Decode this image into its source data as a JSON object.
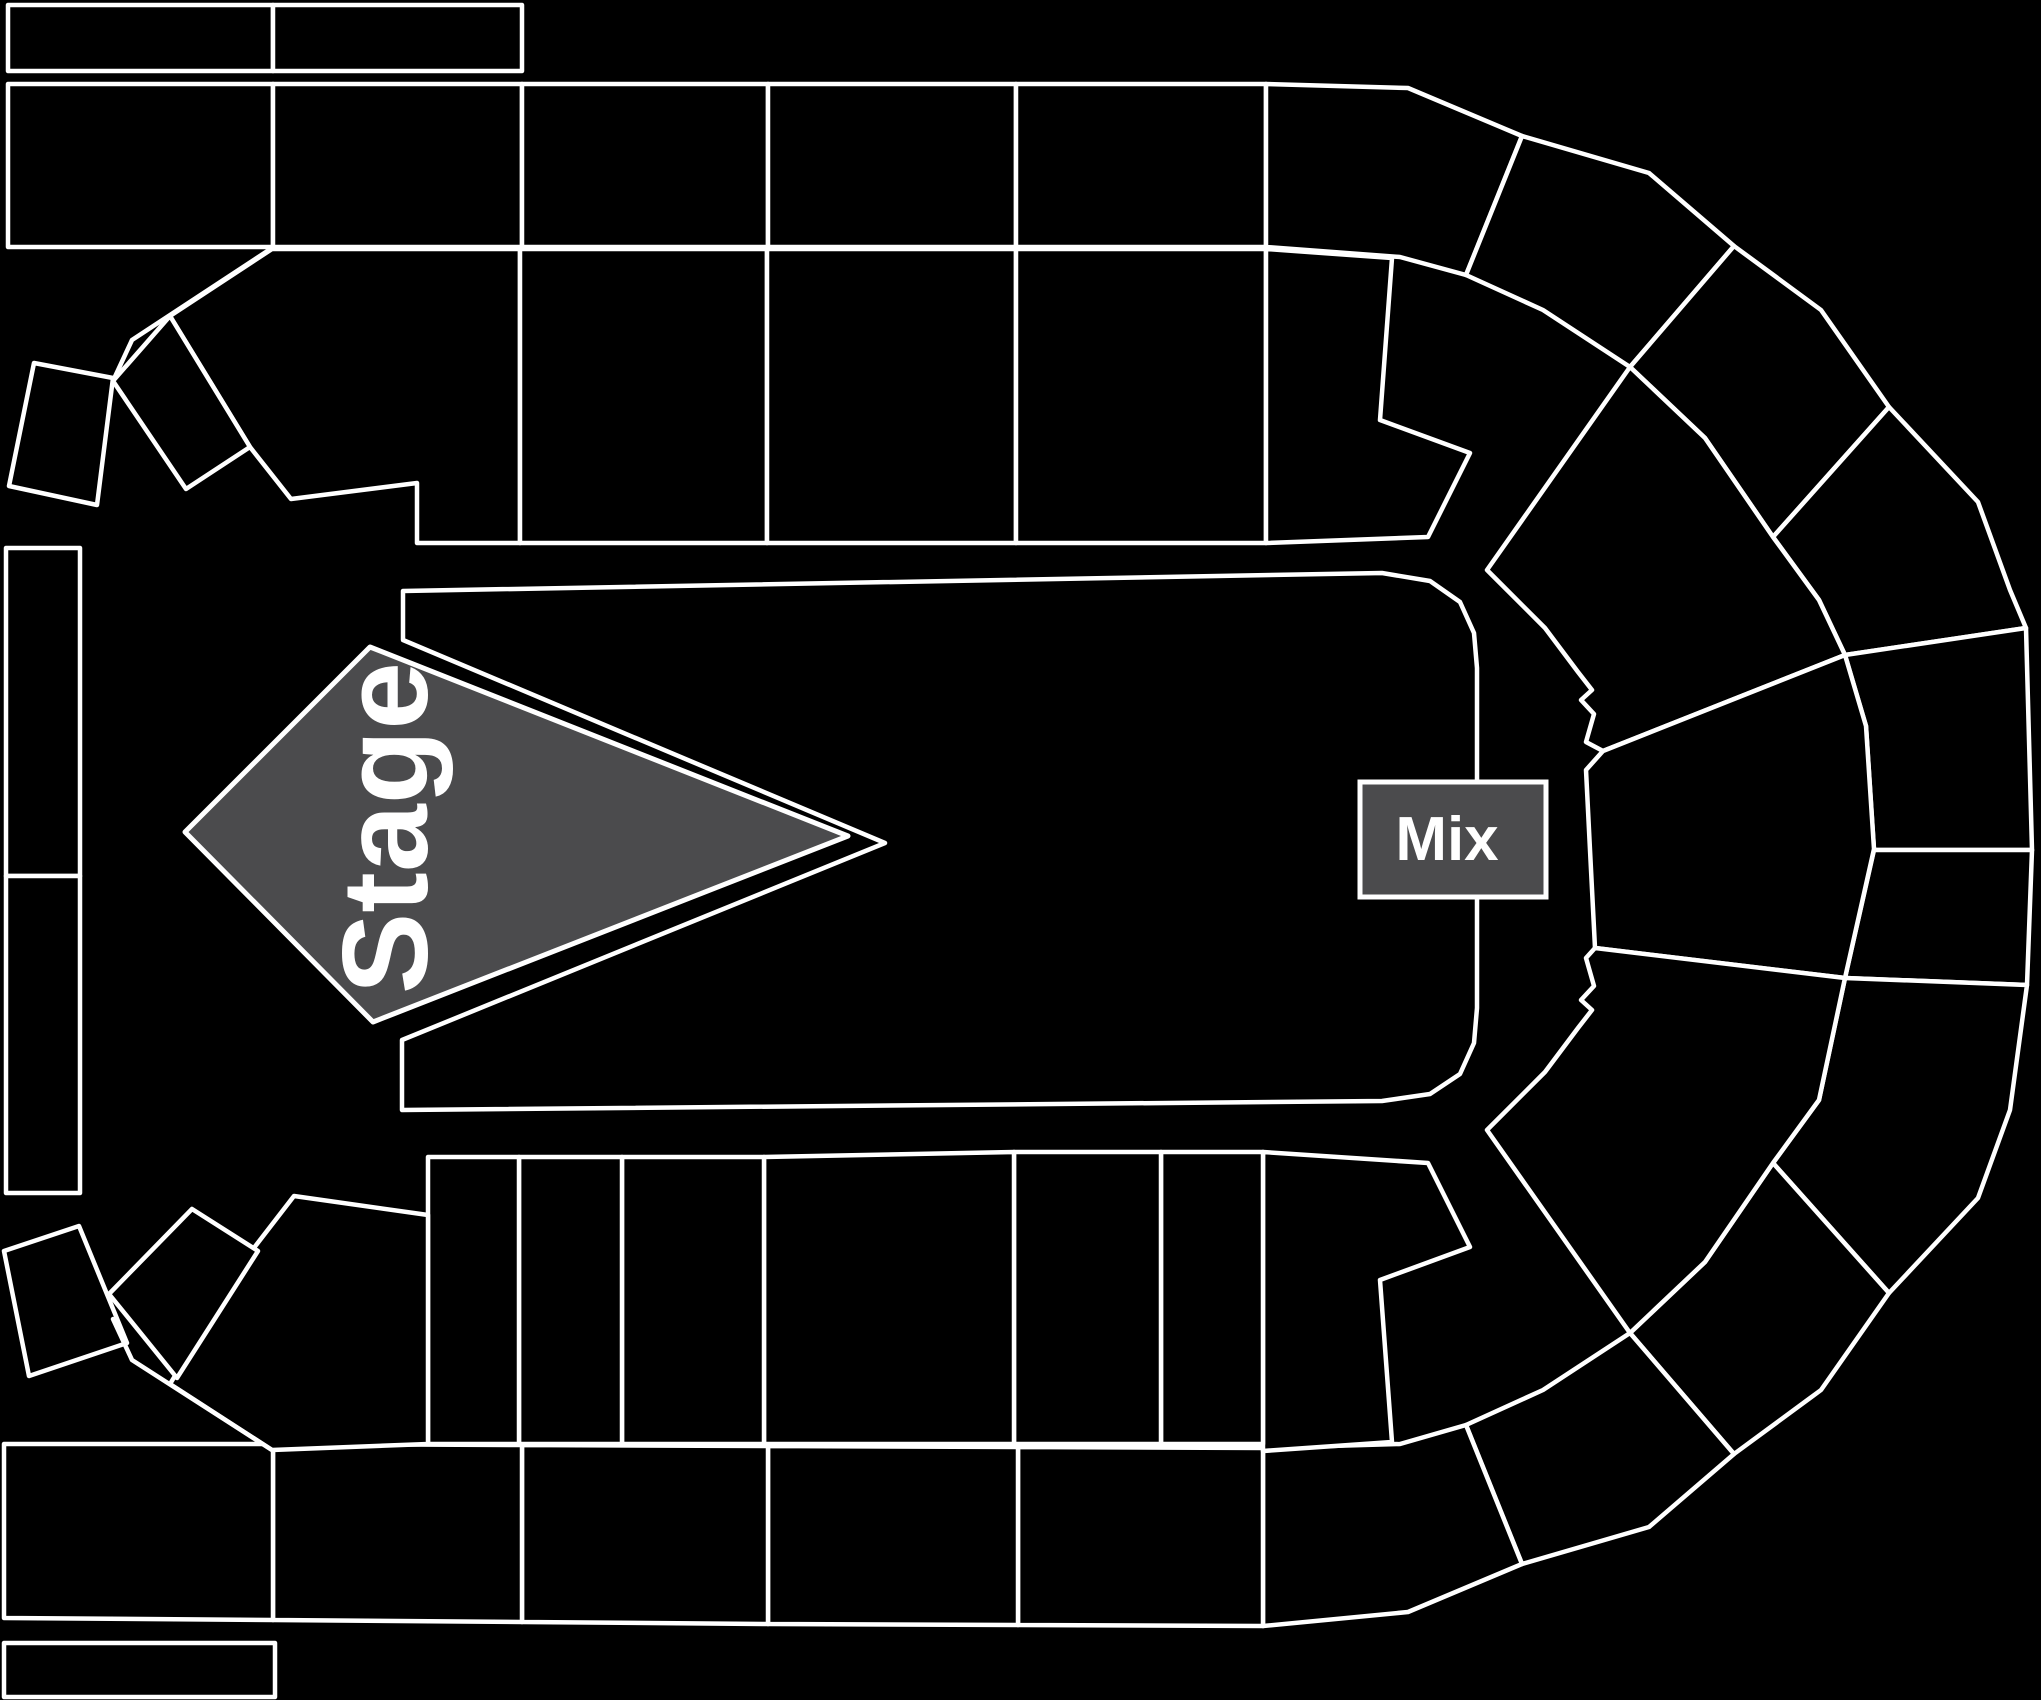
{
  "map": {
    "background": "#000000",
    "line_color": "#ffffff",
    "line_width": 4.5,
    "section_fill": "#000000",
    "booth_fill": "#4b4b4d",
    "stage": {
      "label": "Stage",
      "fill": "#4b4b4d",
      "points": [
        [
          370,
          647
        ],
        [
          848,
          836
        ],
        [
          373,
          1022
        ],
        [
          185,
          832
        ]
      ],
      "label_x": 385,
      "label_y": 828,
      "label_size": 122,
      "label_rotation": -90
    },
    "mix": {
      "label": "Mix",
      "fill": "#4b4b4d",
      "x": 1360,
      "y": 782,
      "w": 186,
      "h": 115,
      "label_size": 62
    },
    "floor": {
      "name": "floor-general-admission",
      "points": [
        [
          403,
          591
        ],
        [
          1382,
          573
        ],
        [
          1430,
          581
        ],
        [
          1460,
          602
        ],
        [
          1474,
          633
        ],
        [
          1477,
          668
        ],
        [
          1477,
          1008
        ],
        [
          1474,
          1043
        ],
        [
          1460,
          1074
        ],
        [
          1430,
          1094
        ],
        [
          1382,
          1101
        ],
        [
          402,
          1110
        ],
        [
          402,
          1040
        ],
        [
          885,
          843
        ],
        [
          403,
          640
        ]
      ]
    },
    "sections": [
      {
        "name": "section-top-row-1",
        "points": [
          [
            8,
            5
          ],
          [
            273,
            5
          ],
          [
            273,
            71
          ],
          [
            8,
            71
          ]
        ]
      },
      {
        "name": "section-top-row-2",
        "points": [
          [
            273,
            5
          ],
          [
            522,
            5
          ],
          [
            522,
            71
          ],
          [
            273,
            71
          ]
        ]
      },
      {
        "name": "section-upper-tier-1",
        "points": [
          [
            8,
            84
          ],
          [
            273,
            84
          ],
          [
            273,
            247
          ],
          [
            8,
            247
          ]
        ]
      },
      {
        "name": "section-upper-tier-2",
        "points": [
          [
            273,
            84
          ],
          [
            522,
            84
          ],
          [
            522,
            247
          ],
          [
            273,
            247
          ]
        ]
      },
      {
        "name": "section-upper-tier-3",
        "points": [
          [
            522,
            84
          ],
          [
            768,
            84
          ],
          [
            768,
            247
          ],
          [
            522,
            247
          ]
        ]
      },
      {
        "name": "section-upper-tier-4",
        "points": [
          [
            768,
            84
          ],
          [
            1016,
            84
          ],
          [
            1016,
            247
          ],
          [
            768,
            247
          ]
        ]
      },
      {
        "name": "section-upper-tier-5",
        "points": [
          [
            1016,
            84
          ],
          [
            1266,
            84
          ],
          [
            1266,
            247
          ],
          [
            1016,
            247
          ]
        ]
      },
      {
        "name": "section-upper-tier-corner-1",
        "points": [
          [
            1266,
            84
          ],
          [
            1408,
            88
          ],
          [
            1522,
            136
          ],
          [
            1466,
            275
          ],
          [
            1400,
            257
          ],
          [
            1266,
            247
          ]
        ]
      },
      {
        "name": "section-upper-tier-corner-2",
        "points": [
          [
            1522,
            136
          ],
          [
            1649,
            173
          ],
          [
            1734,
            246
          ],
          [
            1630,
            367
          ],
          [
            1543,
            310
          ],
          [
            1466,
            275
          ]
        ]
      },
      {
        "name": "section-upper-tier-corner-3",
        "points": [
          [
            1734,
            246
          ],
          [
            1821,
            310
          ],
          [
            1889,
            407
          ],
          [
            1773,
            537
          ],
          [
            1705,
            438
          ],
          [
            1630,
            367
          ]
        ]
      },
      {
        "name": "section-upper-tier-corner-4",
        "points": [
          [
            1889,
            407
          ],
          [
            1978,
            502
          ],
          [
            2010,
            590
          ],
          [
            2026,
            628
          ],
          [
            1845,
            655
          ],
          [
            1819,
            600
          ],
          [
            1773,
            537
          ]
        ]
      },
      {
        "name": "section-right-tier-1",
        "points": [
          [
            2026,
            628
          ],
          [
            2032,
            850
          ],
          [
            1874,
            850
          ],
          [
            1866,
            726
          ],
          [
            1845,
            655
          ]
        ]
      },
      {
        "name": "section-right-tier-2",
        "points": [
          [
            2032,
            850
          ],
          [
            2027,
            985
          ],
          [
            1845,
            978
          ],
          [
            1874,
            850
          ]
        ]
      },
      {
        "name": "section-lower-tier-corner-4",
        "points": [
          [
            2027,
            985
          ],
          [
            2010,
            1110
          ],
          [
            1978,
            1198
          ],
          [
            1889,
            1293
          ],
          [
            1773,
            1163
          ],
          [
            1819,
            1100
          ],
          [
            1845,
            978
          ]
        ]
      },
      {
        "name": "section-lower-tier-corner-3",
        "points": [
          [
            1889,
            1293
          ],
          [
            1821,
            1390
          ],
          [
            1734,
            1454
          ],
          [
            1630,
            1333
          ],
          [
            1705,
            1262
          ],
          [
            1773,
            1163
          ]
        ]
      },
      {
        "name": "section-lower-tier-corner-2",
        "points": [
          [
            1734,
            1454
          ],
          [
            1649,
            1527
          ],
          [
            1522,
            1564
          ],
          [
            1466,
            1425
          ],
          [
            1543,
            1390
          ],
          [
            1630,
            1333
          ]
        ]
      },
      {
        "name": "section-lower-tier-corner-1",
        "points": [
          [
            1263,
            1448
          ],
          [
            1400,
            1444
          ],
          [
            1466,
            1425
          ],
          [
            1522,
            1564
          ],
          [
            1408,
            1612
          ],
          [
            1263,
            1626
          ]
        ]
      },
      {
        "name": "section-lower-tier-5",
        "points": [
          [
            1018,
            1447
          ],
          [
            1263,
            1448
          ],
          [
            1263,
            1626
          ],
          [
            1018,
            1625
          ]
        ]
      },
      {
        "name": "section-lower-tier-4",
        "points": [
          [
            768,
            1446
          ],
          [
            1018,
            1447
          ],
          [
            1018,
            1625
          ],
          [
            768,
            1624
          ]
        ]
      },
      {
        "name": "section-lower-tier-3",
        "points": [
          [
            522,
            1445
          ],
          [
            768,
            1446
          ],
          [
            768,
            1624
          ],
          [
            522,
            1622
          ]
        ]
      },
      {
        "name": "section-lower-tier-2",
        "points": [
          [
            273,
            1444
          ],
          [
            522,
            1445
          ],
          [
            522,
            1622
          ],
          [
            273,
            1620
          ]
        ]
      },
      {
        "name": "section-lower-tier-1",
        "points": [
          [
            4,
            1444
          ],
          [
            273,
            1444
          ],
          [
            273,
            1620
          ],
          [
            4,
            1618
          ]
        ]
      },
      {
        "name": "section-bottom-row-1",
        "points": [
          [
            4,
            1643
          ],
          [
            275,
            1643
          ],
          [
            275,
            1697
          ],
          [
            4,
            1697
          ]
        ]
      },
      {
        "name": "section-inner-top-left",
        "points": [
          [
            272,
            249
          ],
          [
            520,
            249
          ],
          [
            520,
            543
          ],
          [
            417,
            543
          ],
          [
            417,
            483
          ],
          [
            291,
            499
          ],
          [
            250,
            447
          ],
          [
            170,
            316
          ]
        ]
      },
      {
        "name": "section-inner-top-2",
        "points": [
          [
            520,
            249
          ],
          [
            767,
            249
          ],
          [
            767,
            543
          ],
          [
            520,
            543
          ]
        ]
      },
      {
        "name": "section-inner-top-3",
        "points": [
          [
            767,
            249
          ],
          [
            1016,
            249
          ],
          [
            1016,
            543
          ],
          [
            767,
            543
          ]
        ]
      },
      {
        "name": "section-inner-top-4",
        "points": [
          [
            1016,
            249
          ],
          [
            1266,
            249
          ],
          [
            1266,
            543
          ],
          [
            1016,
            543
          ]
        ]
      },
      {
        "name": "section-inner-top-right",
        "points": [
          [
            1266,
            249
          ],
          [
            1392,
            258
          ],
          [
            1380,
            420
          ],
          [
            1470,
            453
          ],
          [
            1428,
            537
          ],
          [
            1266,
            543
          ]
        ]
      },
      {
        "name": "section-fan-top-right",
        "points": [
          [
            1630,
            367
          ],
          [
            1705,
            438
          ],
          [
            1773,
            537
          ],
          [
            1819,
            600
          ],
          [
            1845,
            655
          ],
          [
            1603,
            751
          ],
          [
            1586,
            742
          ],
          [
            1594,
            714
          ],
          [
            1581,
            700
          ],
          [
            1592,
            690
          ],
          [
            1578,
            672
          ],
          [
            1545,
            628
          ],
          [
            1487,
            570
          ]
        ]
      },
      {
        "name": "section-fan-right",
        "points": [
          [
            1845,
            655
          ],
          [
            1866,
            726
          ],
          [
            1874,
            849
          ],
          [
            1845,
            978
          ],
          [
            1595,
            948
          ],
          [
            1590,
            850
          ],
          [
            1586,
            770
          ],
          [
            1603,
            751
          ]
        ]
      },
      {
        "name": "section-fan-bottom-right",
        "points": [
          [
            1845,
            978
          ],
          [
            1819,
            1100
          ],
          [
            1773,
            1163
          ],
          [
            1705,
            1262
          ],
          [
            1630,
            1333
          ],
          [
            1487,
            1130
          ],
          [
            1545,
            1072
          ],
          [
            1578,
            1028
          ],
          [
            1592,
            1010
          ],
          [
            1581,
            1000
          ],
          [
            1594,
            986
          ],
          [
            1586,
            958
          ],
          [
            1595,
            948
          ]
        ]
      },
      {
        "name": "section-inner-bottom-right",
        "points": [
          [
            1263,
            1152
          ],
          [
            1428,
            1163
          ],
          [
            1470,
            1247
          ],
          [
            1380,
            1280
          ],
          [
            1392,
            1442
          ],
          [
            1263,
            1451
          ]
        ]
      },
      {
        "name": "section-inner-bottom-6",
        "points": [
          [
            1161,
            1152
          ],
          [
            1263,
            1152
          ],
          [
            1263,
            1444
          ],
          [
            1161,
            1444
          ]
        ]
      },
      {
        "name": "section-inner-bottom-5",
        "points": [
          [
            1014,
            1152
          ],
          [
            1161,
            1152
          ],
          [
            1161,
            1444
          ],
          [
            1014,
            1444
          ]
        ]
      },
      {
        "name": "section-inner-bottom-4",
        "points": [
          [
            764,
            1157
          ],
          [
            1014,
            1152
          ],
          [
            1014,
            1444
          ],
          [
            764,
            1444
          ]
        ]
      },
      {
        "name": "section-inner-bottom-3",
        "points": [
          [
            622,
            1157
          ],
          [
            764,
            1157
          ],
          [
            764,
            1444
          ],
          [
            622,
            1444
          ]
        ]
      },
      {
        "name": "section-inner-bottom-2",
        "points": [
          [
            519,
            1157
          ],
          [
            622,
            1157
          ],
          [
            622,
            1444
          ],
          [
            519,
            1444
          ]
        ]
      },
      {
        "name": "section-inner-bottom-1",
        "points": [
          [
            428,
            1157
          ],
          [
            519,
            1157
          ],
          [
            519,
            1444
          ],
          [
            428,
            1444
          ]
        ]
      },
      {
        "name": "section-inner-bottom-left-corner",
        "points": [
          [
            294,
            1196
          ],
          [
            428,
            1215
          ],
          [
            428,
            1444
          ],
          [
            272,
            1450
          ],
          [
            170,
            1384
          ],
          [
            250,
            1253
          ]
        ]
      },
      {
        "name": "section-left-column-1",
        "points": [
          [
            6,
            548
          ],
          [
            80,
            548
          ],
          [
            80,
            876
          ],
          [
            6,
            876
          ]
        ]
      },
      {
        "name": "section-left-column-2",
        "points": [
          [
            6,
            876
          ],
          [
            80,
            876
          ],
          [
            80,
            1193
          ],
          [
            6,
            1193
          ]
        ]
      },
      {
        "name": "section-wedge-top-left-1",
        "points": [
          [
            34,
            363
          ],
          [
            113,
            378
          ],
          [
            97,
            505
          ],
          [
            9,
            486
          ]
        ]
      },
      {
        "name": "section-wedge-top-left-2",
        "points": [
          [
            113,
            381
          ],
          [
            170,
            316
          ],
          [
            250,
            447
          ],
          [
            186,
            489
          ]
        ]
      },
      {
        "name": "section-wedge-bottom-left-1",
        "points": [
          [
            4,
            1251
          ],
          [
            79,
            1226
          ],
          [
            127,
            1343
          ],
          [
            29,
            1376
          ]
        ]
      },
      {
        "name": "section-wedge-bottom-left-2",
        "points": [
          [
            109,
            1294
          ],
          [
            192,
            1209
          ],
          [
            258,
            1251
          ],
          [
            177,
            1378
          ]
        ]
      }
    ],
    "lines": [
      {
        "name": "divider-top-left",
        "points": [
          [
            272,
            248
          ],
          [
            132,
            340
          ],
          [
            113,
            381
          ]
        ]
      },
      {
        "name": "divider-bottom-left",
        "points": [
          [
            272,
            1450
          ],
          [
            132,
            1360
          ],
          [
            113,
            1319
          ]
        ]
      }
    ]
  }
}
